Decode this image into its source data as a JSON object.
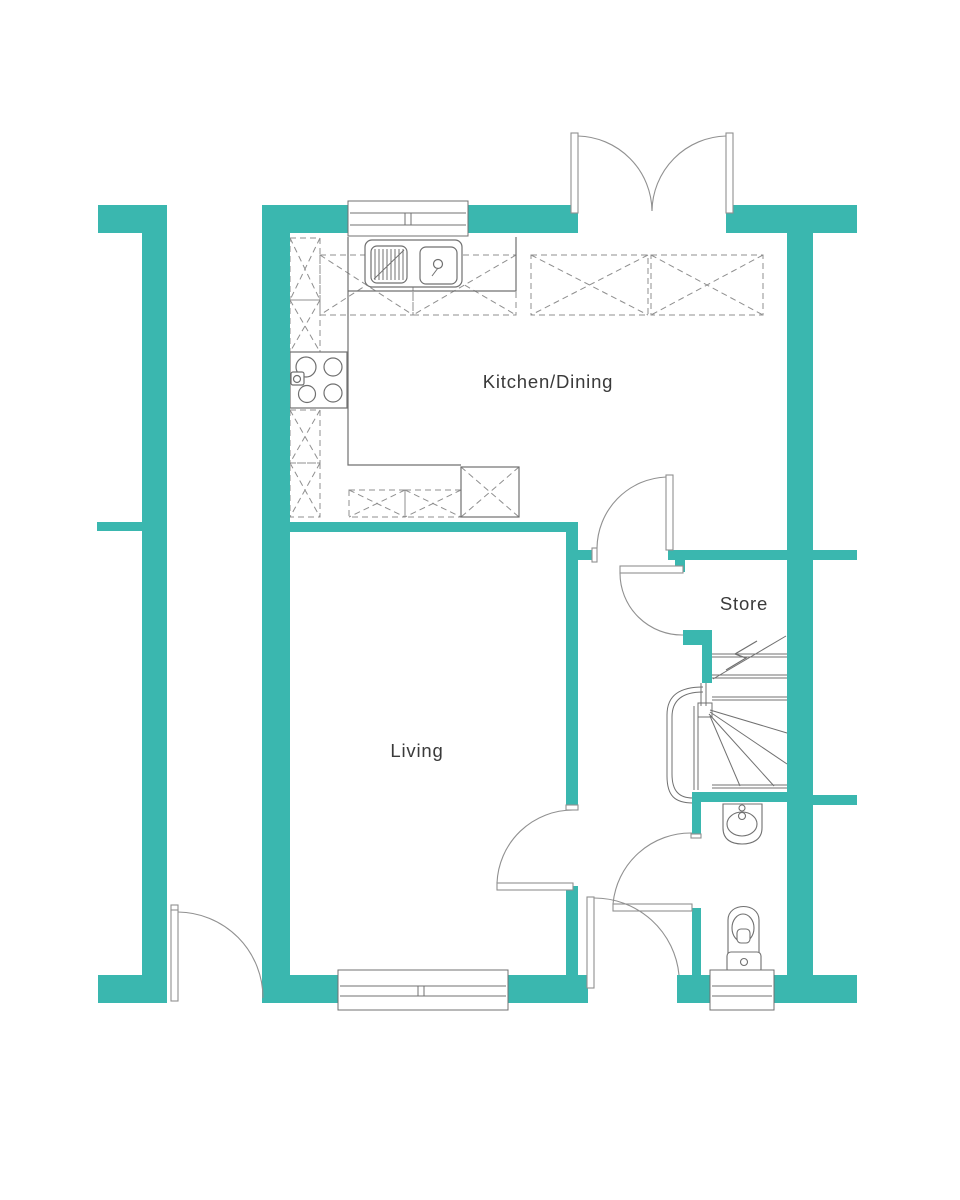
{
  "plan": {
    "title": "Ground floor plan",
    "rooms": [
      {
        "id": "kitchen-dining",
        "label": "Kitchen/Dining"
      },
      {
        "id": "living",
        "label": "Living"
      },
      {
        "id": "store",
        "label": "Store"
      }
    ],
    "colors": {
      "wall": "#3ab7af",
      "line": "#707070",
      "dash": "#8f8f8f",
      "arc": "#909090",
      "label": "#3a3a3a",
      "background": "#ffffff"
    },
    "fixtures": [
      "french-doors-icon",
      "kitchen-window-icon",
      "kitchen-sink-icon",
      "hob-icon",
      "worktop-units-icon",
      "appliance-icon",
      "stairs-up-icon",
      "handrail-icon",
      "wc-basin-icon",
      "wc-toilet-icon",
      "wc-window-icon",
      "living-window-icon",
      "door-swing-icons"
    ]
  }
}
